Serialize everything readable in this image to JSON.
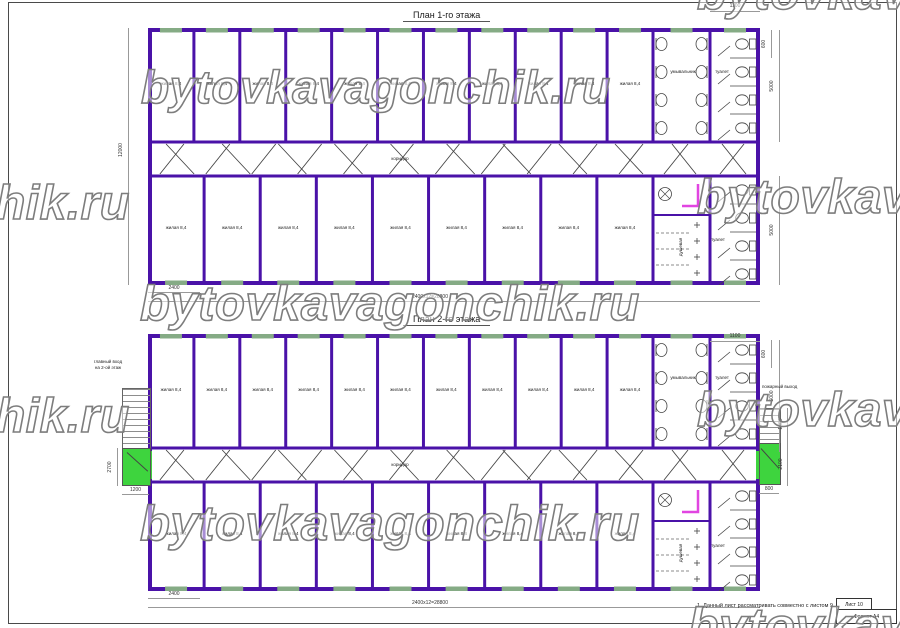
{
  "watermark": {
    "text": "bytovkavagonchik.ru",
    "stroke_color": "#7d7d7d"
  },
  "colors": {
    "wall": "#4a12a8",
    "window": "#85ab85",
    "door_green": "#3ed43e",
    "accent_magenta": "#e145e1",
    "fixture": "#444444",
    "dim_line": "#999999"
  },
  "rooms": {
    "living_label": "жилая 8,4",
    "corridor": "коридор",
    "washroom": "умывальник",
    "toilet": "туалет",
    "shower": "душевая"
  },
  "plan1": {
    "title": "План 1-го этажа",
    "top_room_count": 11,
    "bottom_room_count": 9,
    "dims": {
      "height": "12000",
      "module": "2400",
      "total": "2400x12=28800",
      "san_width": "1100",
      "win": "600",
      "room_depth_top": "5000",
      "room_depth_bottom": "5000"
    }
  },
  "plan2": {
    "title": "План 2-го этажа",
    "top_room_count": 11,
    "bottom_room_count": 9,
    "dims": {
      "module": "2400",
      "total": "2400x12=28800",
      "san_width": "1100",
      "win": "600",
      "room_depth_top": "5000",
      "landing_h": "2700",
      "landing_w": "1200",
      "stair_run": "1400",
      "landing2_h": "2100",
      "landing2_w": "800"
    },
    "labels": {
      "entrance": "главный вход\nна 2-ой этаж",
      "fire_exit": "пожарный выход"
    }
  },
  "titleblock": {
    "note": "1. Данный лист рассматривать совместно с листом 9.",
    "sheet": "Лист 10",
    "format": "Формат А4"
  }
}
